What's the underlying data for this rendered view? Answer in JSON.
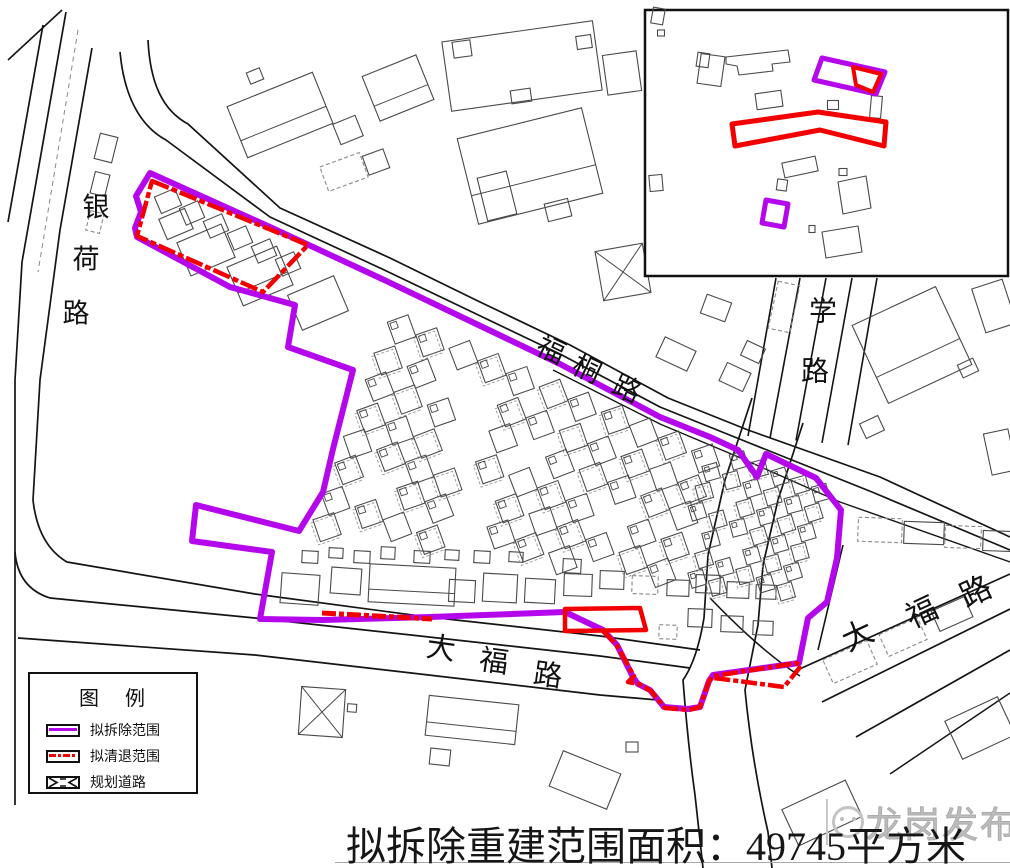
{
  "map": {
    "road_labels": [
      {
        "id": "yinhe",
        "text": "银荷路"
      },
      {
        "id": "futong",
        "text": "福桐路"
      },
      {
        "id": "xue",
        "text": "学路"
      },
      {
        "id": "dafu_south",
        "text": "大福路"
      },
      {
        "id": "dafu_east",
        "text": "大福路"
      }
    ],
    "inset": {
      "description": "location-inset-map"
    }
  },
  "legend": {
    "title": "图例",
    "items": [
      {
        "label": "拟拆除范围",
        "type": "demolition"
      },
      {
        "label": "拟清退范围",
        "type": "clearance"
      },
      {
        "label": "规划道路",
        "type": "planned_road"
      }
    ]
  },
  "caption": {
    "text": "拟拆除重建范围面积：49745平方米",
    "area_value": "49745",
    "area_unit": "平方米"
  },
  "watermark": {
    "text": "龙岗发布"
  },
  "colors": {
    "demolition": "#B507EC",
    "clearance": "#F20000",
    "road": "#141414",
    "building": "#4A4A4A",
    "building_dashed": "#8A8A8A",
    "watermark": "#BDBDBD",
    "text": "#111111"
  }
}
